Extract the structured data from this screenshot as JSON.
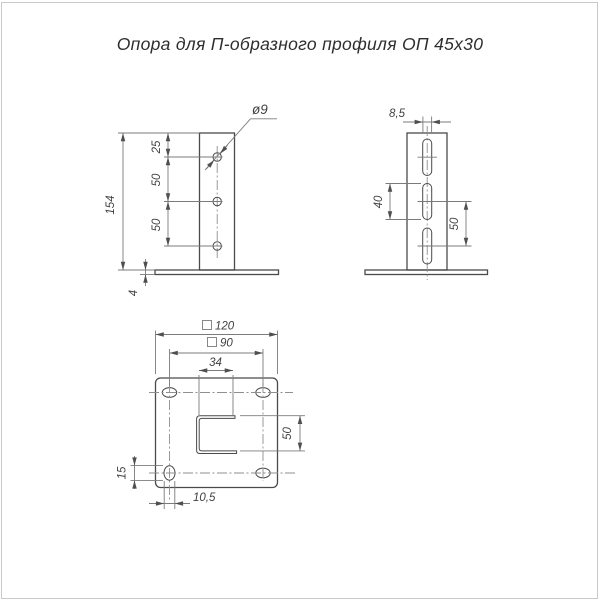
{
  "title": "Опора для П-образного профиля ОП 45х30",
  "front": {
    "total_height": "154",
    "top_to_hole": "25",
    "hole_pitch_a": "50",
    "hole_pitch_b": "50",
    "base_thickness": "4",
    "hole_dia": "ø9"
  },
  "side": {
    "slot_width": "8,5",
    "slot_length": "40",
    "slot_pitch": "50"
  },
  "plan": {
    "plate_size": "120",
    "bolt_pattern": "90",
    "square_symbol": "",
    "channel_width": "34",
    "channel_depth": "50",
    "hole_offset": "15",
    "slot_hole_width": "10,5"
  },
  "colors": {
    "contour": "#4a4a4a",
    "thin_line": "#7b7b7b",
    "centerline": "#8f8f8f",
    "text": "#414141",
    "frame": "#c9c9c9"
  }
}
